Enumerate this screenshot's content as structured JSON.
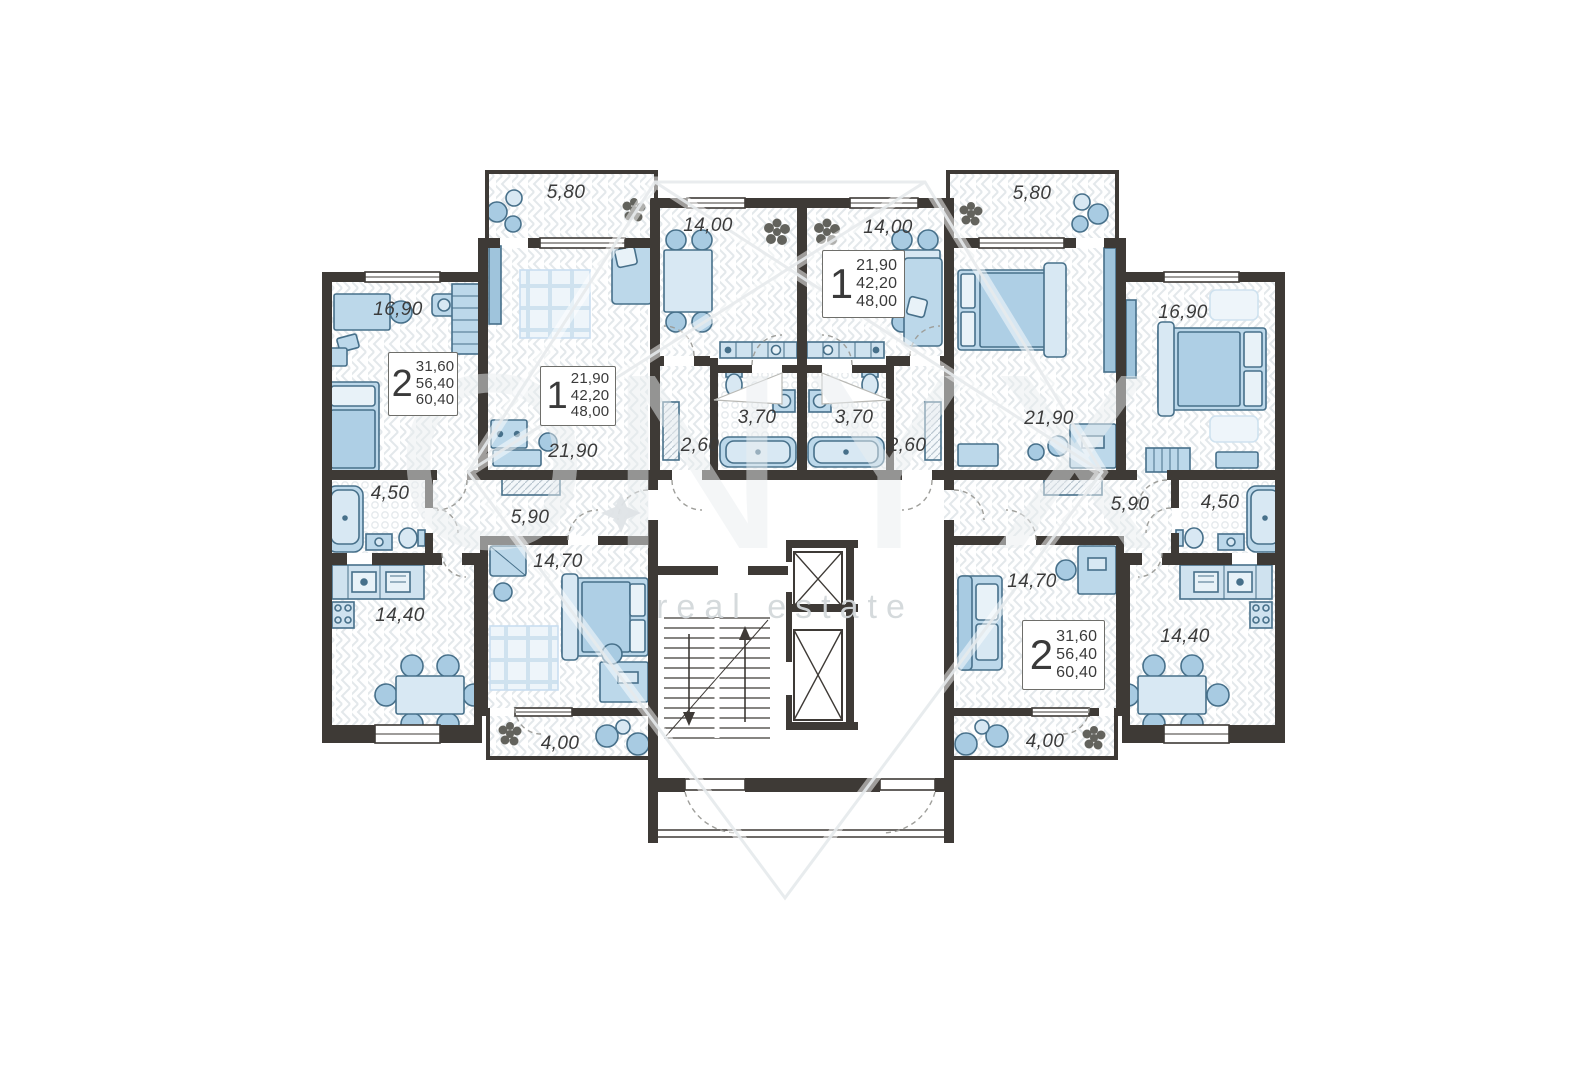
{
  "watermark": {
    "brand": "ONYX",
    "subtitle": "real estate"
  },
  "units": {
    "two_room_left": {
      "rooms": "2",
      "v1": "31,60",
      "v2": "56,40",
      "v3": "60,40"
    },
    "one_room_left": {
      "rooms": "1",
      "v1": "21,90",
      "v2": "42,20",
      "v3": "48,00"
    },
    "one_room_right": {
      "rooms": "1",
      "v1": "21,90",
      "v2": "42,20",
      "v3": "48,00"
    },
    "two_room_right": {
      "rooms": "2",
      "v1": "31,60",
      "v2": "56,40",
      "v3": "60,40"
    }
  },
  "areas": {
    "balcony_tl": "5,80",
    "bedroom_tl": "16,90",
    "living_l": "21,90",
    "kitchen_l": "14,00",
    "bath_l": "3,70",
    "hall_l": "2,60",
    "kitchen_r": "14,00",
    "bath_r": "3,70",
    "hall_r": "2,60",
    "balcony_tr": "5,80",
    "living_r": "21,90",
    "bedroom_tr": "16,90",
    "bath_bl": "4,50",
    "hall_bl": "5,90",
    "bedroom_bl": "14,70",
    "kitchen_bl": "14,40",
    "balcony_bl": "4,00",
    "bedroom_br": "14,70",
    "hall_br": "5,90",
    "bath_br": "4,50",
    "kitchen_br": "14,40",
    "balcony_br": "4,00"
  }
}
